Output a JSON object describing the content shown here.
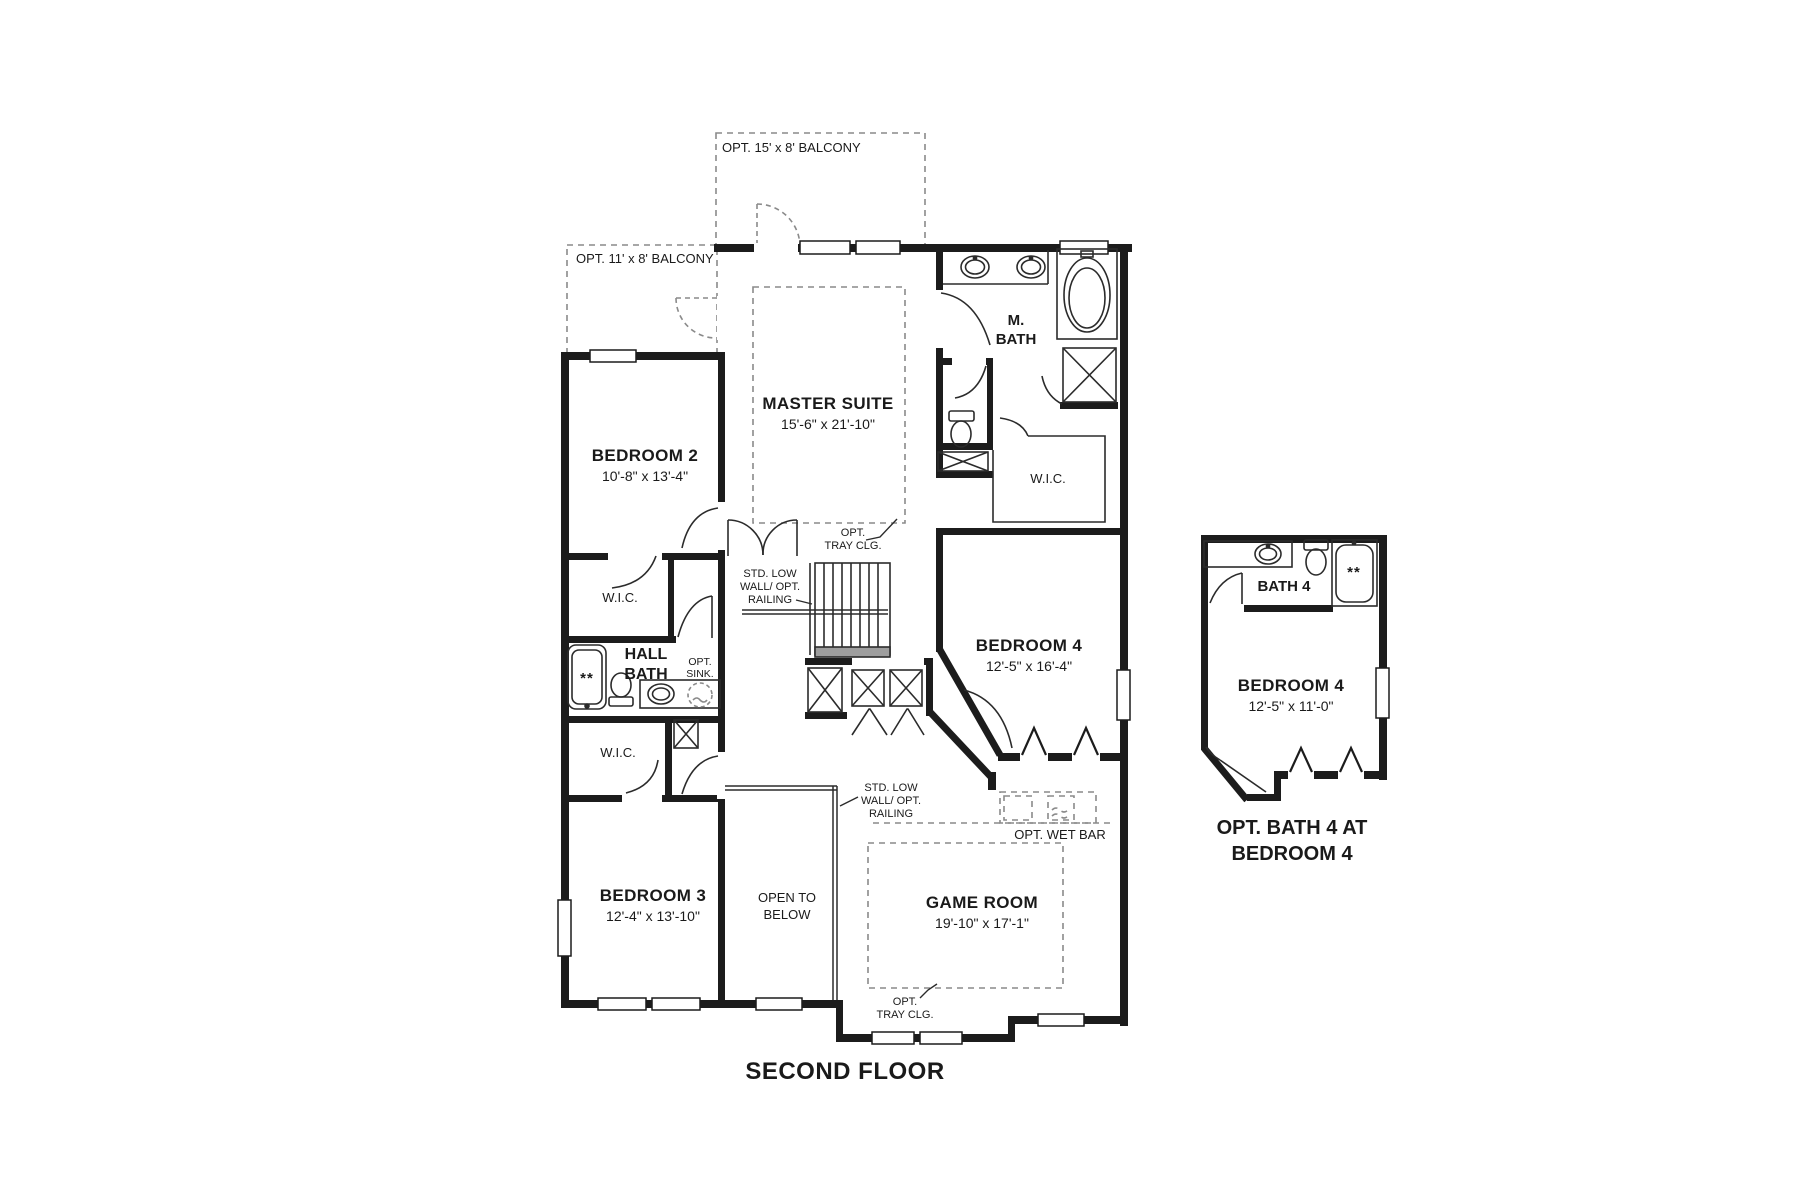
{
  "title": "SECOND FLOOR",
  "balconies": {
    "top": "OPT. 15' x 8' BALCONY",
    "left": "OPT. 11' x 8' BALCONY"
  },
  "rooms": {
    "master_suite": {
      "name": "MASTER SUITE",
      "dims": "15'-6\" x 21'-10\""
    },
    "bedroom2": {
      "name": "BEDROOM 2",
      "dims": "10'-8\" x 13'-4\""
    },
    "bedroom3": {
      "name": "BEDROOM 3",
      "dims": "12'-4\" x 13'-10\""
    },
    "bedroom4": {
      "name": "BEDROOM 4",
      "dims": "12'-5\" x 16'-4\""
    },
    "game_room": {
      "name": "GAME ROOM",
      "dims": "19'-10\" x 17'-1\""
    },
    "m_bath": {
      "line1": "M.",
      "line2": "BATH"
    },
    "hall_bath": {
      "line1": "HALL",
      "line2": "BATH"
    },
    "bath4": {
      "name": "BATH 4"
    },
    "bedroom4_opt": {
      "name": "BEDROOM 4",
      "dims": "12'-5\" x 11'-0\""
    },
    "open_below": {
      "line1": "OPEN TO",
      "line2": "BELOW"
    },
    "wic": "W.I.C."
  },
  "annotations": {
    "opt_tray": {
      "line1": "OPT.",
      "line2": "TRAY CLG."
    },
    "std_low_wall": {
      "line1": "STD. LOW",
      "line2": "WALL/ OPT.",
      "line3": "RAILING"
    },
    "opt_wet_bar": "OPT. WET BAR",
    "opt_sink": {
      "line1": "OPT.",
      "line2": "SINK."
    },
    "stars": "**",
    "caption": {
      "line1": "OPT. BATH 4 AT",
      "line2": "BEDROOM 4"
    }
  }
}
